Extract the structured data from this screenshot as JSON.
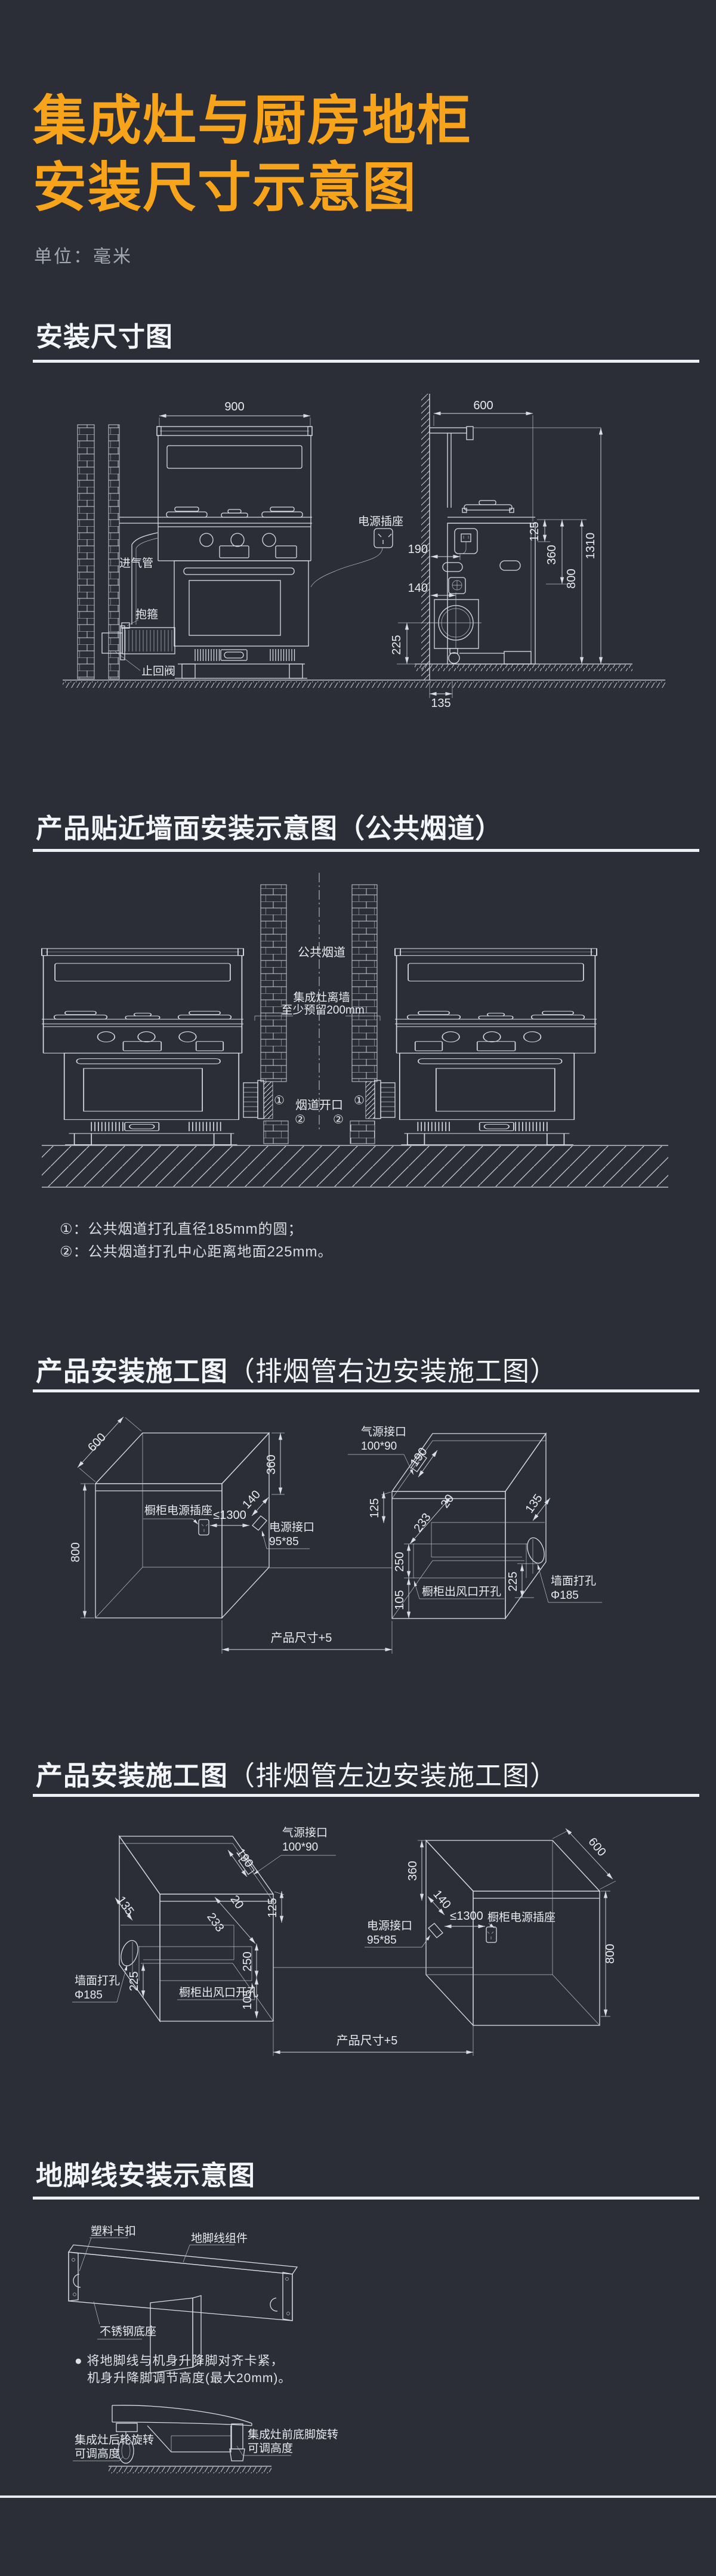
{
  "title": {
    "line1": "集成灶与厨房地柜",
    "line2": "安装尺寸示意图"
  },
  "unit_note": "单位：毫米",
  "colors": {
    "background": "#2B2D37",
    "accent_orange": "#F8A41B",
    "line_white": "#D9DDE5",
    "text_white": "#F3F5F8",
    "muted_gray": "#A4A8B2"
  },
  "s1": {
    "heading": "安装尺寸图",
    "dim900": "900",
    "dim600": "600",
    "dim1310": "1310",
    "dim800": "800",
    "dim360": "360",
    "dim125": "125",
    "dim190": "190",
    "dim140": "140",
    "dim225": "225",
    "dim135": "135",
    "label_gas": "进气管",
    "label_clamp": "抱箍",
    "label_valve": "止回阀",
    "label_socket": "电源插座"
  },
  "s2": {
    "heading": "产品贴近墙面安装示意图（公共烟道）",
    "label_flue": "公共烟道",
    "gap1": "集成灶离墙",
    "gap2": "至少预留200mm",
    "opening": "烟道开口",
    "m1": "①",
    "m2": "②",
    "note1": "①：公共烟道打孔直径185mm的圆；",
    "note2": "②：公共烟道打孔中心距离地面225mm。"
  },
  "s3": {
    "heading_main": "产品安装施工图",
    "heading_sub": "（排烟管右边安装施工图）",
    "dim600": "600",
    "dim800": "800",
    "dim360": "360",
    "dim140": "140",
    "socket_label": "橱柜电源插座",
    "dim1300": "≤1300",
    "power1": "电源接口",
    "power2": "95*85",
    "product": "产品尺寸+5",
    "gas1": "气源接口",
    "gas2": "100*90",
    "dim190": "190",
    "dim125": "125",
    "dim20": "20",
    "dim233": "233",
    "dim250": "250",
    "dim105": "105",
    "dim135": "135",
    "dim225": "225",
    "outlet": "橱柜出风口开孔",
    "wall1": "墙面打孔",
    "wall2": "Φ185"
  },
  "s4": {
    "heading_main": "产品安装施工图",
    "heading_sub": "（排烟管左边安装施工图）",
    "dim600": "600",
    "dim800": "800",
    "dim360": "360",
    "dim140": "140",
    "socket_label": "橱柜电源插座",
    "dim1300": "≤1300",
    "power1": "电源接口",
    "power2": "95*85",
    "product": "产品尺寸+5",
    "gas1": "气源接口",
    "gas2": "100*90",
    "dim190": "190",
    "dim125": "125",
    "dim20": "20",
    "dim233": "233",
    "dim250": "250",
    "dim105": "105",
    "dim135": "135",
    "dim225": "225",
    "outlet": "橱柜出风口开孔",
    "wall1": "墙面打孔",
    "wall2": "Φ185"
  },
  "s5": {
    "heading": "地脚线安装示意图",
    "clip": "塑料卡扣",
    "assembly": "地脚线组件",
    "base": "不锈钢底座",
    "bullet": "●",
    "note1": "将地脚线与机身升降脚对齐卡紧，",
    "note2": "机身升降脚调节高度(最大20mm)。",
    "rear1": "集成灶后轮旋转",
    "rear2": "可调高度",
    "front1": "集成灶前底脚旋转",
    "front2": "可调高度"
  }
}
